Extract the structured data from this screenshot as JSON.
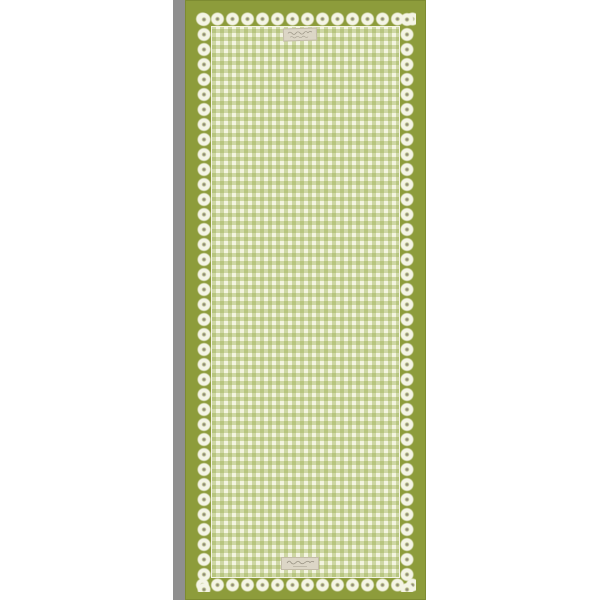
{
  "image_type": "product-photo",
  "subject": "Green gingham table runner with cream lace trim and olive green border, photographed full-length on a white background with a gray shadow along its left side",
  "colors": {
    "page_bg": "#ffffff",
    "shadow_gray": "#8f8f8f",
    "olive": "#8d9c3b",
    "olive_dark": "#7d8b31",
    "lace_cream": "#f4f4e5",
    "gingham_base": "#f3f4e0",
    "gingham_stripe": "rgba(146,168,66,0.38)",
    "tag_bg": "#dcd6c6",
    "tag_border": "#c3bca8",
    "tag_ink": "#8f897a"
  },
  "tags": {
    "top": {
      "text": ""
    },
    "bottom": {
      "text": ""
    }
  }
}
